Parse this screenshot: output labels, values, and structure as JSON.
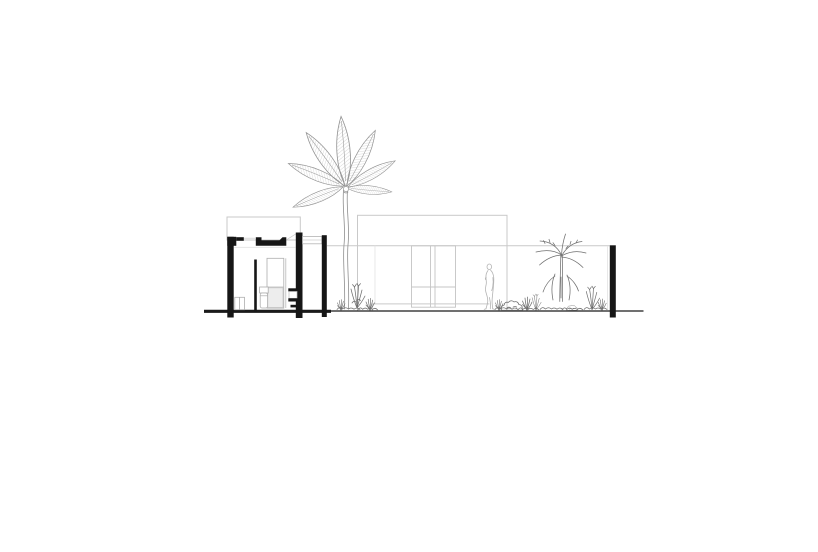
{
  "document": {
    "title": "Architectural cross-section with banana tree and garden",
    "type": "black-and-white architectural section / elevation drawing",
    "paper_color": "#ffffff"
  },
  "palette": {
    "section_cut_black": "#161616",
    "elevation_outline_gray": "#c9c9c9",
    "faint_line_gray": "#e2e2e2",
    "planting_line_gray": "#6f6f6f",
    "tree_line_gray": "#8f8f8f",
    "figure_outline_gray": "#b4b4b4",
    "ground_line_black": "#1a1a1a"
  },
  "scene": {
    "description": "Section through a small flat-roofed pavilion (black poché) at left with interior door, WC and shelving; pergola beam on a slender post; tall banana tree at centre; light-gray rear house elevation with central glazed double door; low terrace plinth; garden bed with shrubs, grass tufts, reeds and a young palm; standing human figure for scale; black cut post of the boundary wall at far right; continuous ground datum line.",
    "elements": [
      {
        "name": "section-pavilion",
        "role": "cut building volume — walls and roof slab in solid black with interior door, WC, storage box and shelf unit"
      },
      {
        "name": "pergola",
        "role": "thin beam and slender black post linking the pavilion to the garden wall"
      },
      {
        "name": "banana-tree",
        "role": "tall banana plant with hatched oval leaves and wavy double-line trunk"
      },
      {
        "name": "background-elevation",
        "role": "rear house facade drawn in light gray with a central glazed double door"
      },
      {
        "name": "terrace-plinth",
        "role": "low terrace slab in front of the facade"
      },
      {
        "name": "human-figure",
        "role": "standing person in light gray outline"
      },
      {
        "name": "garden-planting",
        "role": "shrubs, grass tufts, reeds and a young palm along the ground"
      },
      {
        "name": "boundary-post",
        "role": "black sectioned post of the garden boundary wall"
      },
      {
        "name": "ground-line",
        "role": "horizontal ground datum — thick through the cut slab, thin across the garden"
      }
    ]
  }
}
